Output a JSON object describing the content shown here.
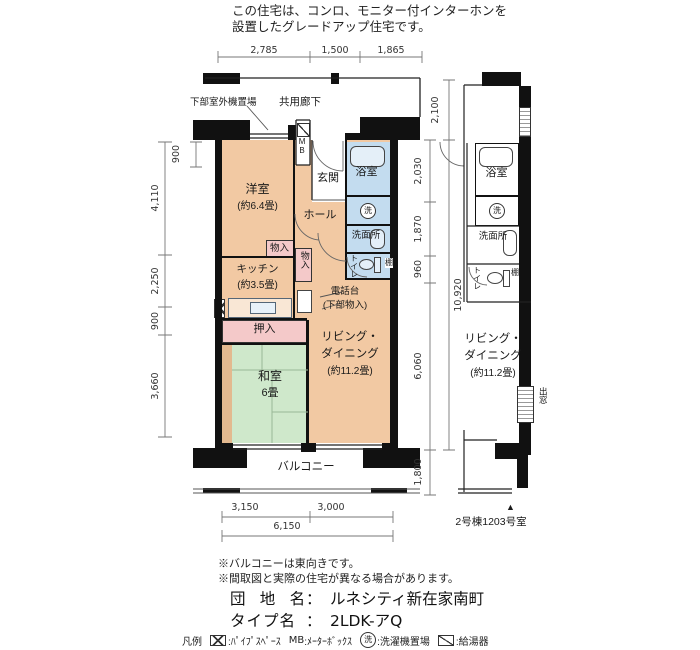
{
  "header": {
    "line1": "この住宅は、コンロ、モニター付インターホンを",
    "line2": "設置したグレードアップ住宅です。"
  },
  "plan": {
    "corridor": "共用廊下",
    "outdoor_unit": "下部室外機置場",
    "mb": "MB",
    "wash_mark": "洗",
    "rooms": {
      "western": {
        "name": "洋室",
        "size": "(約6.4畳)"
      },
      "entrance": "玄関",
      "bath": "浴室",
      "hall": "ホール",
      "washroom": "洗面所",
      "toilet": "トイレ",
      "shelf": "棚",
      "closet_a": "物入",
      "closet_b": "物入",
      "kitchen": {
        "name": "キッチン",
        "size": "(約3.5畳)"
      },
      "phone": {
        "line1": "電話台",
        "line2": "(下部物入)"
      },
      "oshiire": "押入",
      "tatami": {
        "name": "和室",
        "size": "6畳"
      },
      "living": {
        "line1": "リビング・",
        "line2": "ダイニング",
        "line3": "(約11.2畳)"
      },
      "balcony": "バルコニー"
    }
  },
  "side_plan": {
    "bath": "浴室",
    "washroom": "洗面所",
    "toilet": "トイレ",
    "shelf": "棚",
    "wash_mark": "洗",
    "living": {
      "line1": "リビング・",
      "line2": "ダイニング",
      "line3": "(約11.2畳)"
    },
    "bay_window": "出窓",
    "marker": "▲",
    "unit": "2号棟1203号室"
  },
  "dims": {
    "top": [
      "2,785",
      "1,500",
      "1,865"
    ],
    "left": [
      "4,110",
      "2,250",
      "900",
      "3,660"
    ],
    "left_inner": "900",
    "right_corridor": "2,100",
    "right_inner": [
      "2,030",
      "1,870",
      "960",
      "6,060",
      "1,800"
    ],
    "right_total": "10,920",
    "bottom": [
      "3,150",
      "3,000"
    ],
    "bottom_total": "6,150"
  },
  "notes": [
    "※バルコニーは東向きです。",
    "※間取図と実際の住宅が異なる場合があります。"
  ],
  "info": {
    "estate_label": "団 地 名",
    "estate_sep": "：",
    "estate_value": "ルネシティ新在家南町",
    "type_label": "タイプ名",
    "type_sep": "：",
    "type_value": "2LDK-アQ"
  },
  "legend": {
    "title": "凡例",
    "pipe_label": ":ﾊﾟｲﾌﾟｽﾍﾟｰｽ",
    "mb_icon": "MB",
    "mb_label": ":ﾒｰﾀｰﾎﾞｯｸｽ",
    "wash_icon": "洗",
    "wash_label": ":洗濯機置場",
    "heater_label": ":給湯器"
  },
  "colors": {
    "room": "#f2c9a3",
    "tatami": "#cfe8cb",
    "closet": "#f4c9c9",
    "wet": "#c3dcef",
    "wall": "#111111"
  }
}
